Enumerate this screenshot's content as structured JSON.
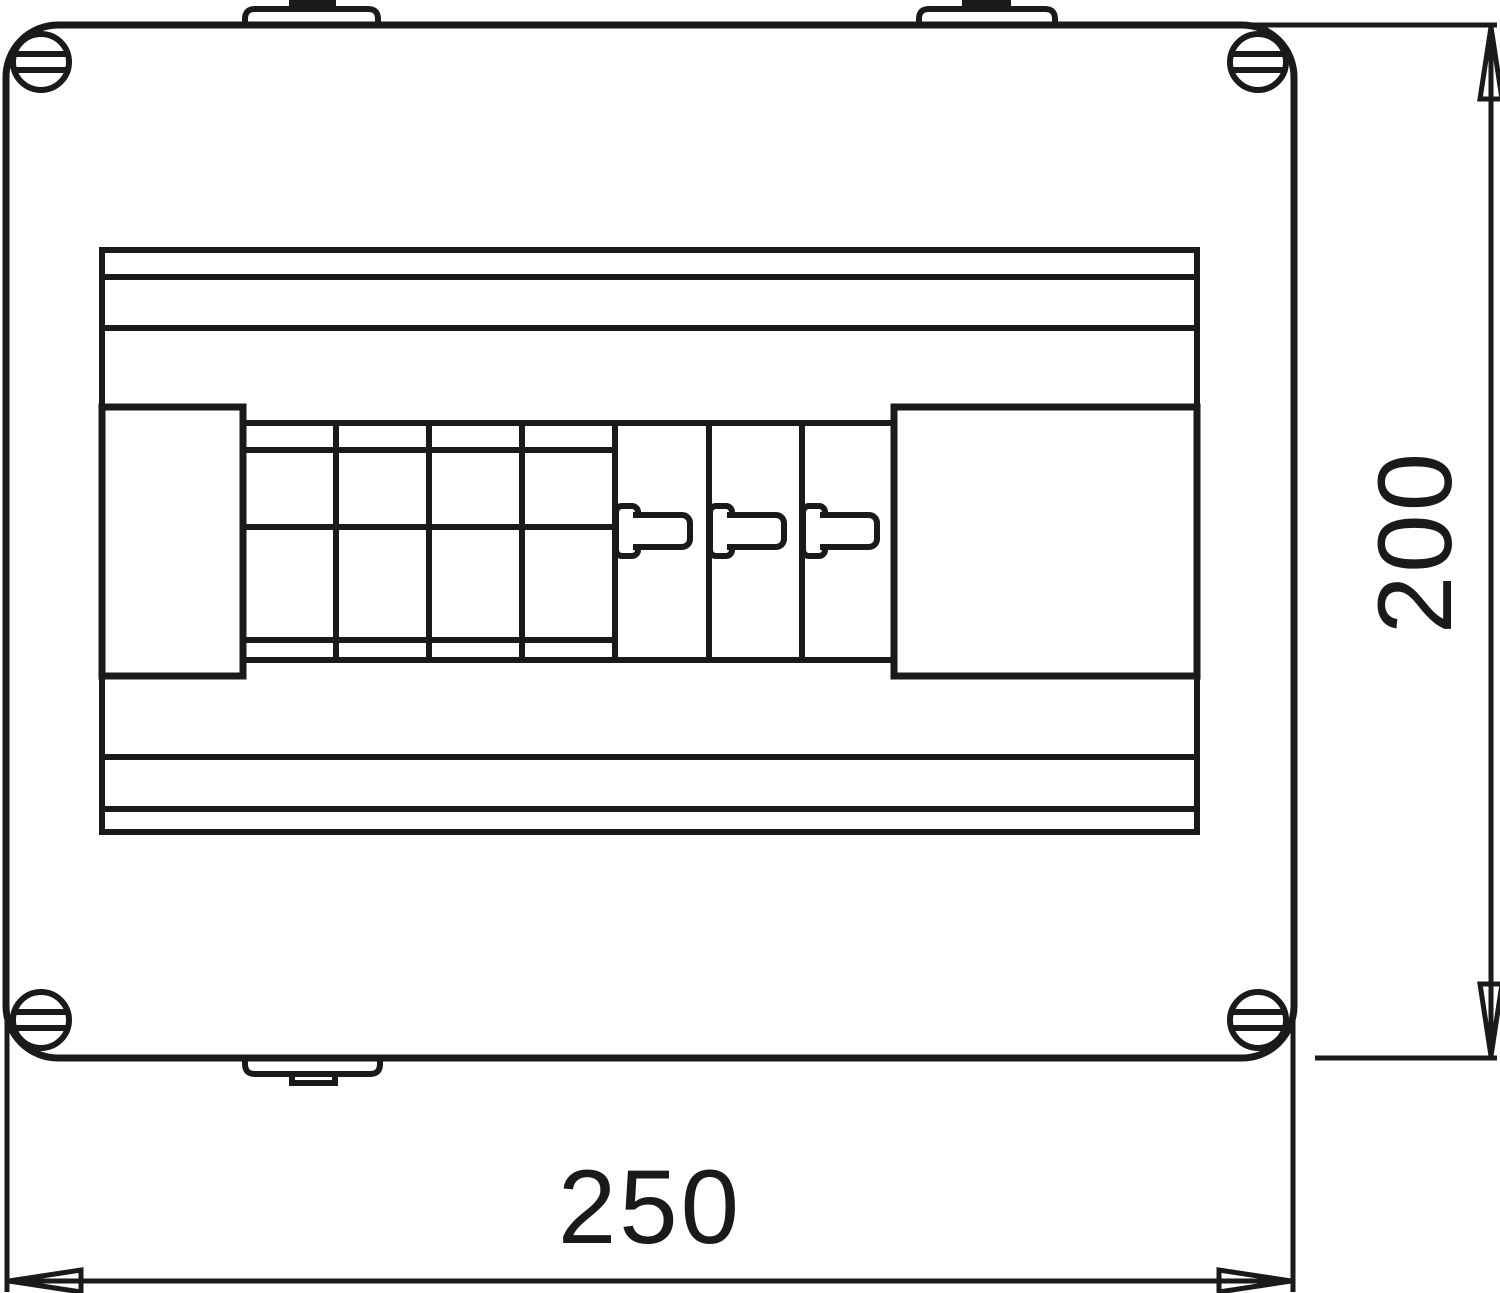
{
  "drawing": {
    "colors": {
      "background": "#ffffff",
      "line": "#1a1a1a"
    },
    "dimension_labels": {
      "width": "250",
      "height": "200"
    },
    "features": {
      "corner_screws": 4,
      "blank_modules": 4,
      "toggle_switch_modules": 3,
      "mounting_tabs_top": 2,
      "mounting_tabs_bottom": 1
    }
  }
}
